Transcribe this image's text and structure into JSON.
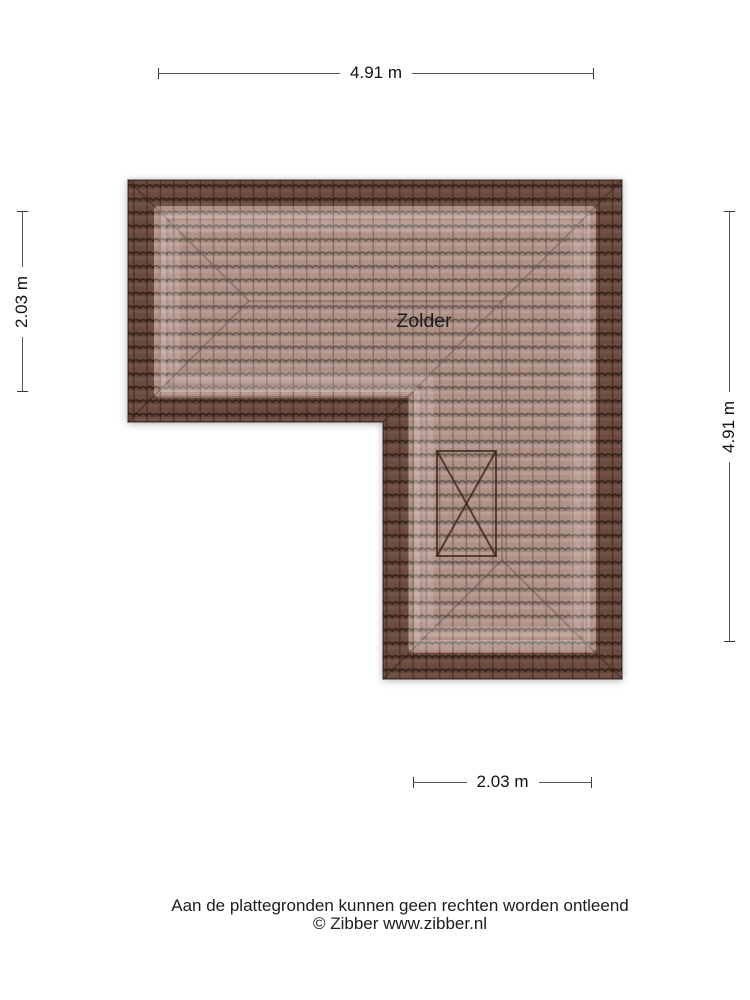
{
  "plan": {
    "room_label": "Zolder",
    "dimensions": {
      "top": "4.91 m",
      "left": "2.03 m",
      "right": "4.91 m",
      "bottom": "2.03 m"
    },
    "features": {
      "window_marker": "roof-window-x"
    }
  },
  "footer": {
    "disclaimer": "Aan de plattegronden kunnen geen rechten worden ontleend",
    "copyright": "© Zibber www.zibber.nl"
  },
  "colors": {
    "tile_base": "#9d7466",
    "tile_line": "#2b1d16",
    "roof_border_dark": "#6b4b3f",
    "inner_highlight": "#b38d7e",
    "dimension_line": "#565656",
    "text": "#111111"
  }
}
